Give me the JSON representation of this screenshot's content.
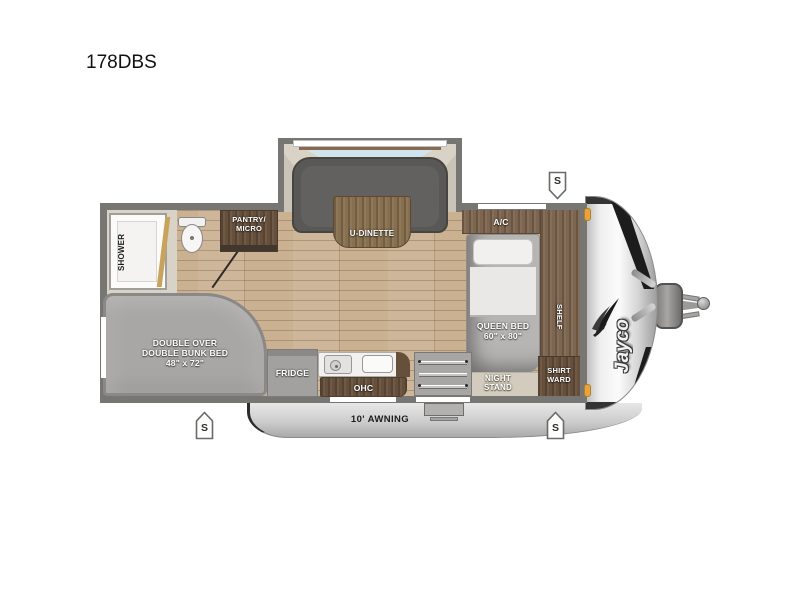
{
  "title": "178DBS",
  "labels": {
    "dinette": "U-DINETTE",
    "shower": "SHOWER",
    "pantry1": "PANTRY/",
    "pantry2": "MICRO",
    "ac": "A/C",
    "queen1": "QUEEN BED",
    "queen2": "60\" x 80\"",
    "shelf": "SHELF",
    "night1": "NIGHT",
    "night2": "STAND",
    "ward1": "SHIRT",
    "ward2": "WARD",
    "bunk1": "DOUBLE OVER",
    "bunk2": "DOUBLE BUNK BED",
    "bunk3": "48\" x 72\"",
    "fridge": "FRIDGE",
    "ohc": "OHC",
    "awning": "10' AWNING",
    "brand": "Jayco",
    "speaker": "S"
  },
  "colors": {
    "wall": "#787672",
    "wood_floor": "#c9b191",
    "slide_floor": "#d9d3c7",
    "cabinet_dark": "#66503c",
    "cabinet_mid": "#7d6550",
    "upholstery_gray": "#5a5856",
    "bed_gray": "#b7b5b3",
    "bunk_gray": "#a9a7a5",
    "marker_amber": "#e8a33c",
    "front_cap_silver": "#e9e9e9"
  }
}
